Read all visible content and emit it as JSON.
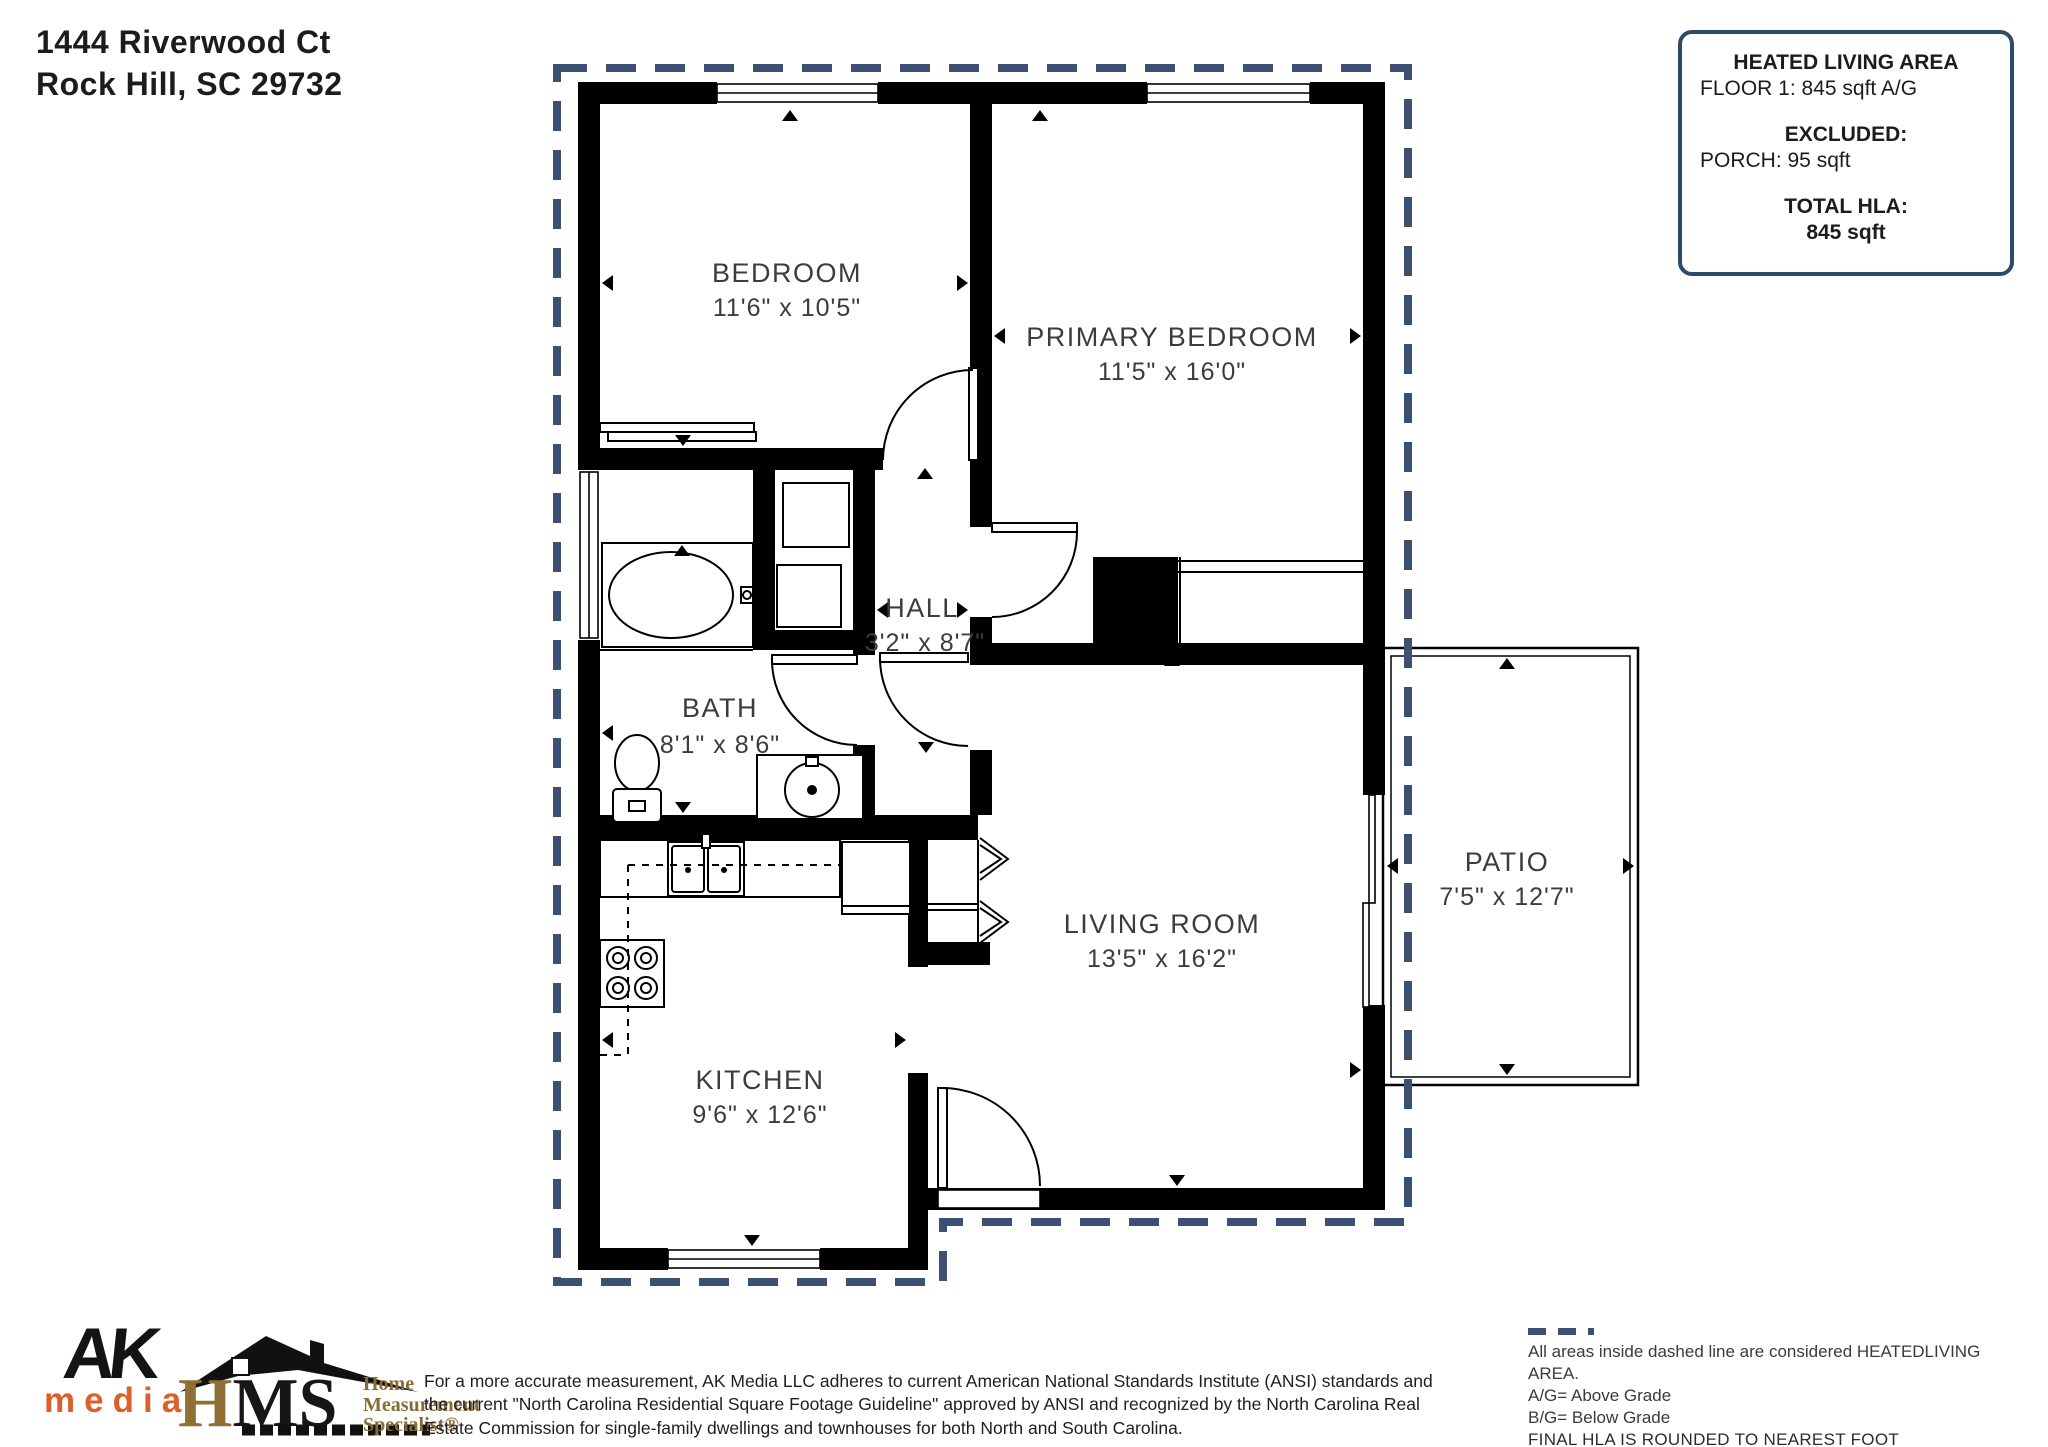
{
  "address": {
    "line1": "1444 Riverwood Ct",
    "line2": "Rock Hill, SC  29732"
  },
  "hla_box": {
    "title": "HEATED LIVING AREA",
    "floor_line": "FLOOR 1: 845 sqft  A/G",
    "excluded_label": "EXCLUDED:",
    "excluded_line": "PORCH: 95 sqft",
    "total_label": "TOTAL HLA:",
    "total_value": "845 sqft"
  },
  "rooms": {
    "bedroom": {
      "name": "BEDROOM",
      "dims": "11'6\" x 10'5\""
    },
    "primary": {
      "name": "PRIMARY BEDROOM",
      "dims": "11'5\" x 16'0\""
    },
    "hall": {
      "name": "HALL",
      "dims": "3'2\" x 8'7\""
    },
    "bath": {
      "name": "BATH",
      "dims": "8'1\" x 8'6\""
    },
    "kitchen": {
      "name": "KITCHEN",
      "dims": "9'6\" x 12'6\""
    },
    "living": {
      "name": "LIVING ROOM",
      "dims": "13'5\" x 16'2\""
    },
    "patio": {
      "name": "PATIO",
      "dims": "7'5\" x 12'7\""
    }
  },
  "legend": {
    "line1": "All areas inside dashed line are considered HEATEDLIVING AREA.",
    "line2": "A/G= Above Grade",
    "line3": "B/G= Below Grade",
    "line4": "FINAL HLA IS ROUNDED TO NEAREST FOOT"
  },
  "disclaimer": {
    "line1": "For a more accurate measurement, AK Media LLC adheres to current American National Standards Institute (ANSI) standards and",
    "line2": "the current \"North Carolina Residential Square Footage Guideline\" approved by ANSI and recognized by the North Carolina Real",
    "line3": "Estate Commission for single-family dwellings and townhouses for both North and South Carolina."
  },
  "logos": {
    "ak_top": "AK",
    "ak_bottom": "media",
    "hms_h": "H",
    "hms_ms": "MS",
    "hms_tag1": "Home",
    "hms_tag2": "Measurement",
    "hms_tag3": "Specialist®"
  },
  "colors": {
    "wall": "#000000",
    "heated_boundary_dash": "#3e4f74",
    "box_border": "#2e4a6b",
    "ak_orange": "#dd5f2b",
    "hms_gold": "#8a6a33"
  }
}
